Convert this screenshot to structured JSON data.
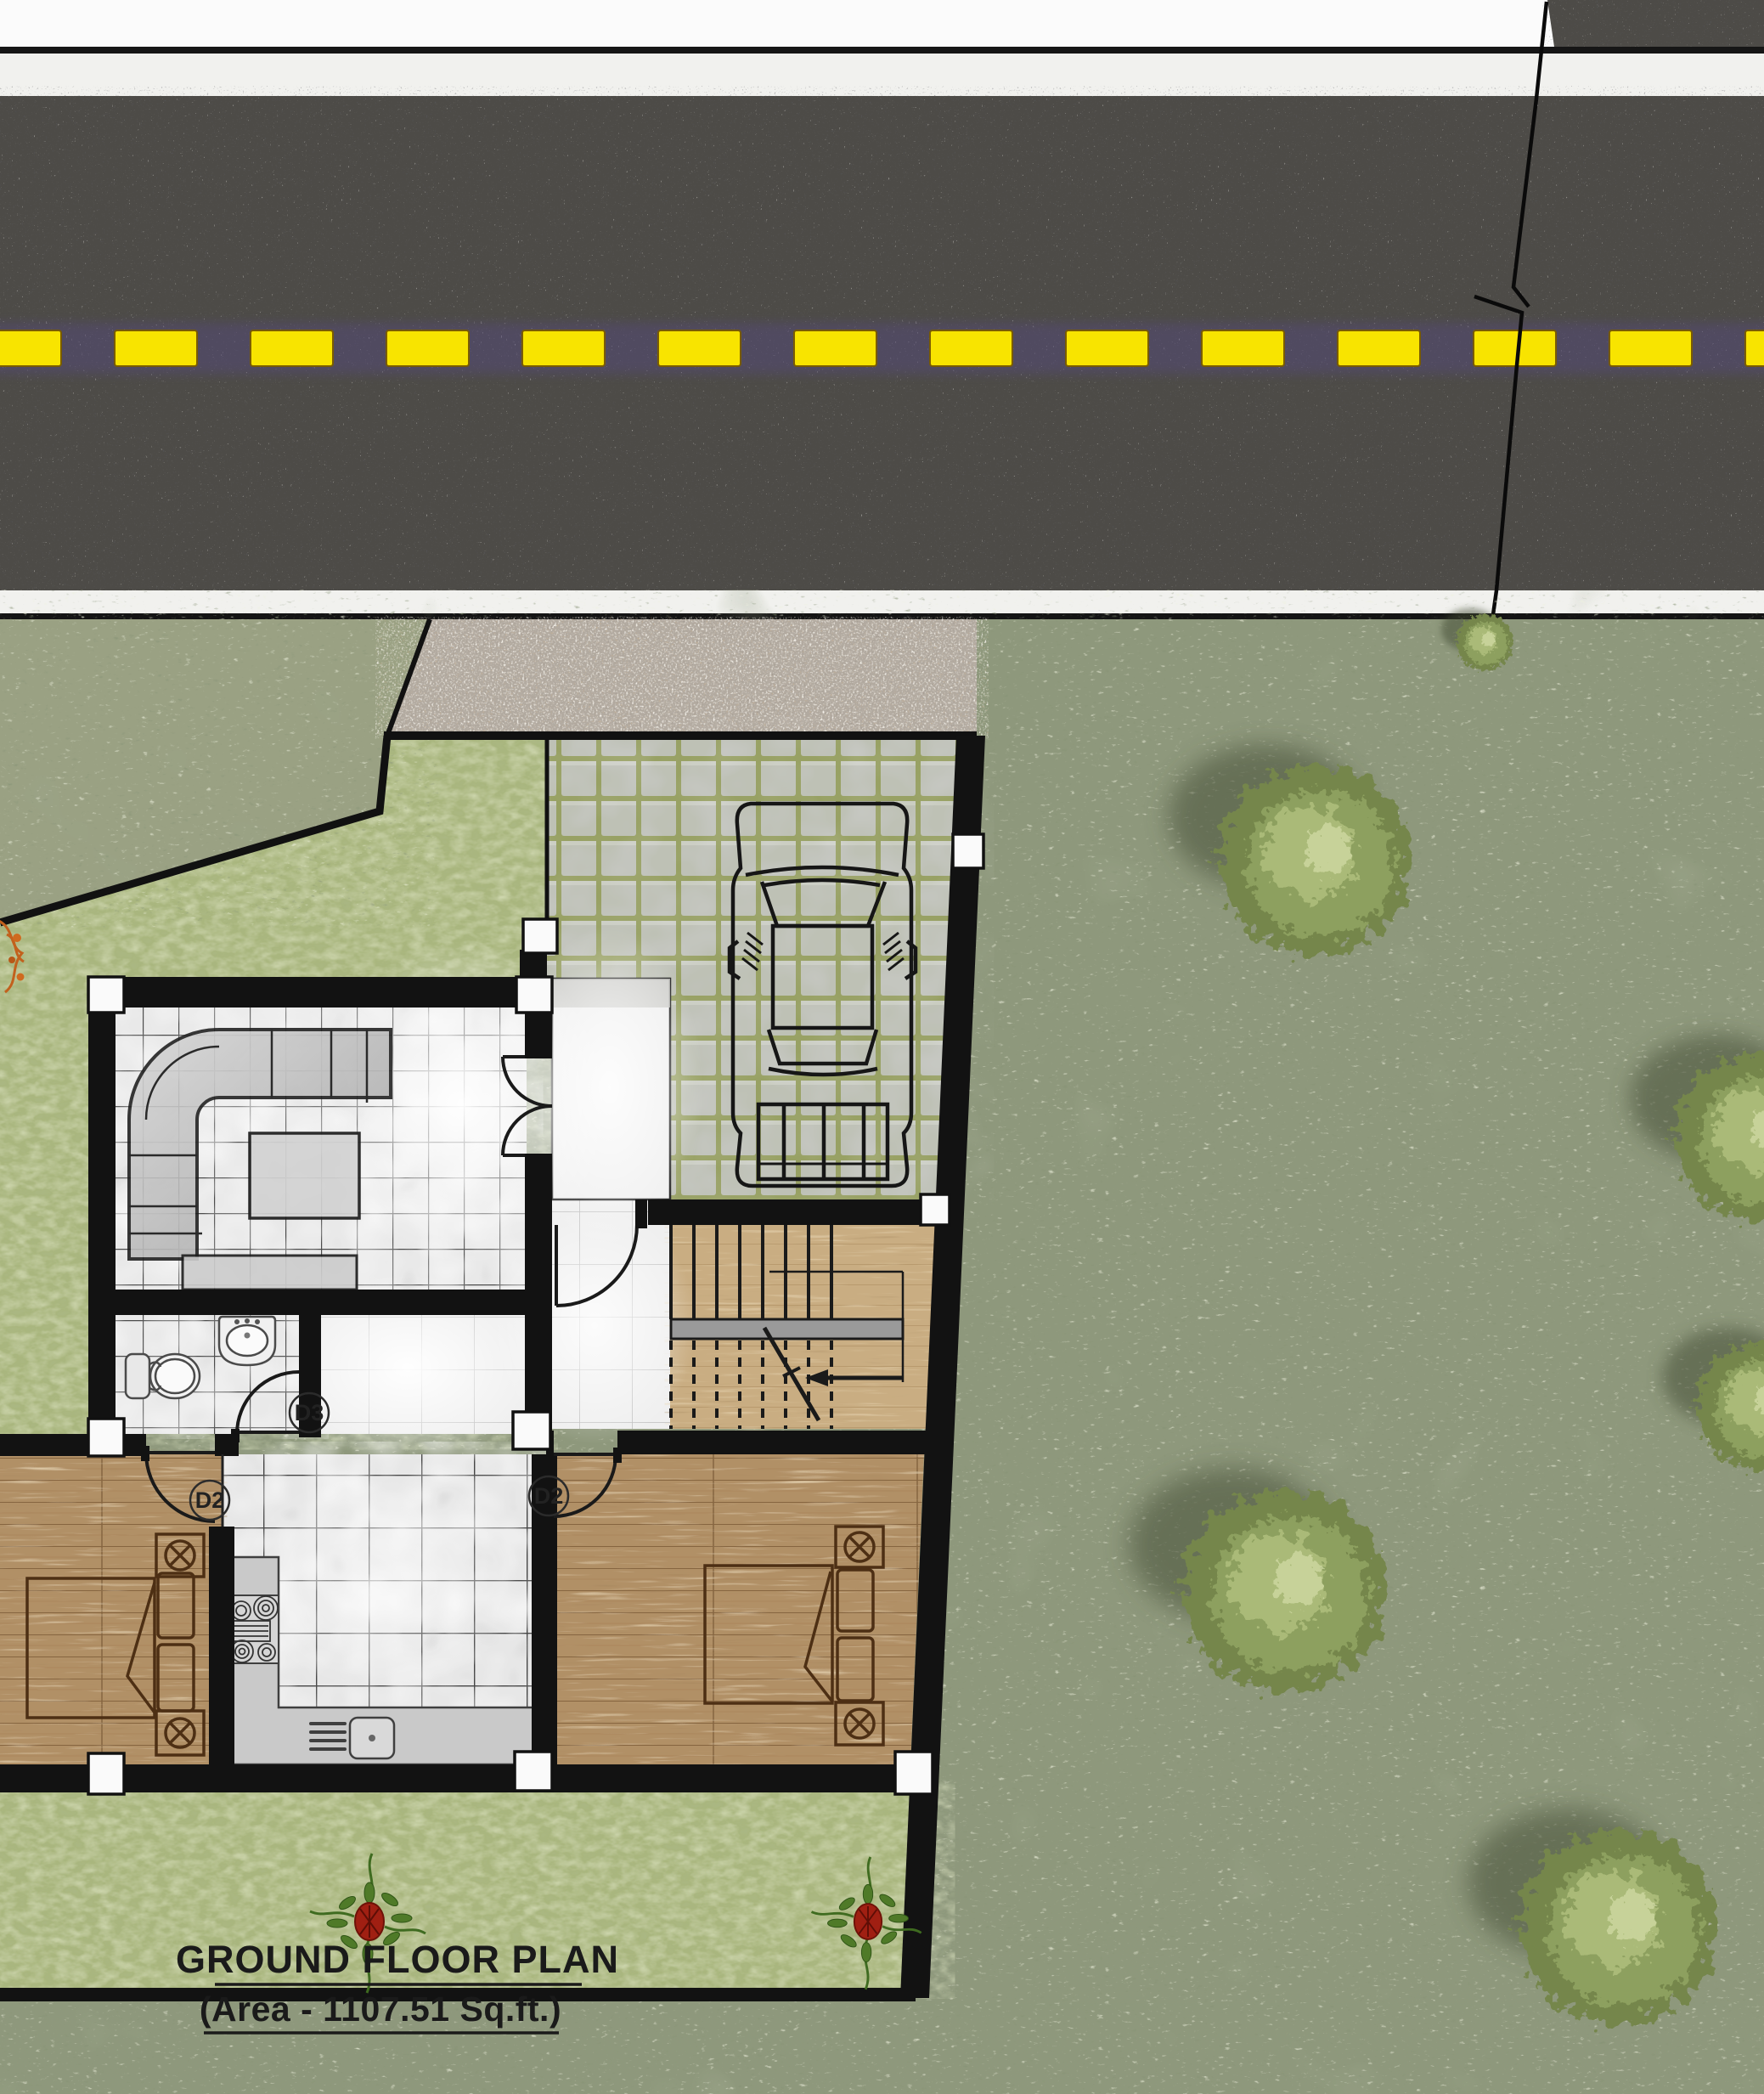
{
  "title": {
    "line1": "GROUND FLOOR PLAN",
    "line2": "(Area - 1107.51 Sq.ft.)"
  },
  "door_labels": {
    "bedroom_left": "D2",
    "bedroom_right": "D2",
    "bathroom": "D3"
  },
  "colors": {
    "road_asphalt": "#4e4b47",
    "lane_marking_yellow": "#f8e400",
    "curb_white": "#f1f1ee",
    "textured_grass": "#8e987b",
    "top_left_grass": "#9aa183",
    "smooth_lawn": "#a9b67e",
    "gravel": "#b2aaa0",
    "paver_tile": "#c5c6c2",
    "paver_grout": "#9aa266",
    "wall_black": "#121212",
    "column_white": "#fafafa",
    "wood_floor": "#b19066",
    "stair_wood": "#c9ad82",
    "interior_tile": "#ececec",
    "bush_green": "#8da05e",
    "flower_red": "#a01f12",
    "title_text": "#1a1a1a"
  }
}
